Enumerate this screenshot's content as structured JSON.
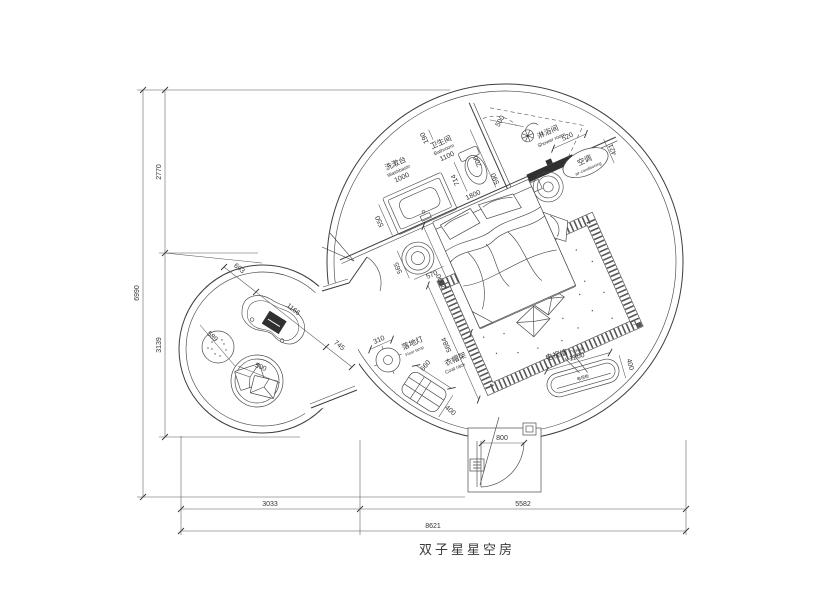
{
  "title": "双子星星空房",
  "labels": {
    "washbasin_cn": "洗漱台",
    "washbasin_en": "Washbasin",
    "bathroom_cn": "卫生间",
    "bathroom_en": "Bathroom",
    "shower_cn": "淋浴间",
    "shower_en": "Shower room",
    "ac_cn": "空调",
    "ac_en": "air-conditioning",
    "lamp_cn": "落地灯",
    "lamp_en": "Floor lamp",
    "rack_cn": "衣帽架",
    "rack_en": "Coat rack",
    "tv_cn": "电视墙",
    "tv_en": "TV wall",
    "tv_cabinet": "电视柜"
  },
  "dims": {
    "overall_w": "8621",
    "overall_h": "6990",
    "left_top": "2770",
    "left_bottom": "3139",
    "bottom_left": "3033",
    "bottom_right": "5582",
    "door": "800",
    "basin_len": "1000",
    "basin_depth": "550",
    "bath_len": "1100",
    "bath_w": "700",
    "niche": "190",
    "toilet": "714",
    "wall_seg": "590",
    "shower_door": "500",
    "ac_w": "520",
    "ac_d": "421",
    "bed_w": "1800",
    "bed_l": "2000",
    "pouf_a": "565",
    "pouf_b": "570",
    "diag": "5684",
    "lamp": "310",
    "rack_len": "660",
    "rack_w": "400",
    "tv_len": "1200",
    "tv_w": "400",
    "table_diag": "1166",
    "gap_a": "693",
    "gap_b": "745",
    "stool": "589",
    "chair": "500"
  }
}
